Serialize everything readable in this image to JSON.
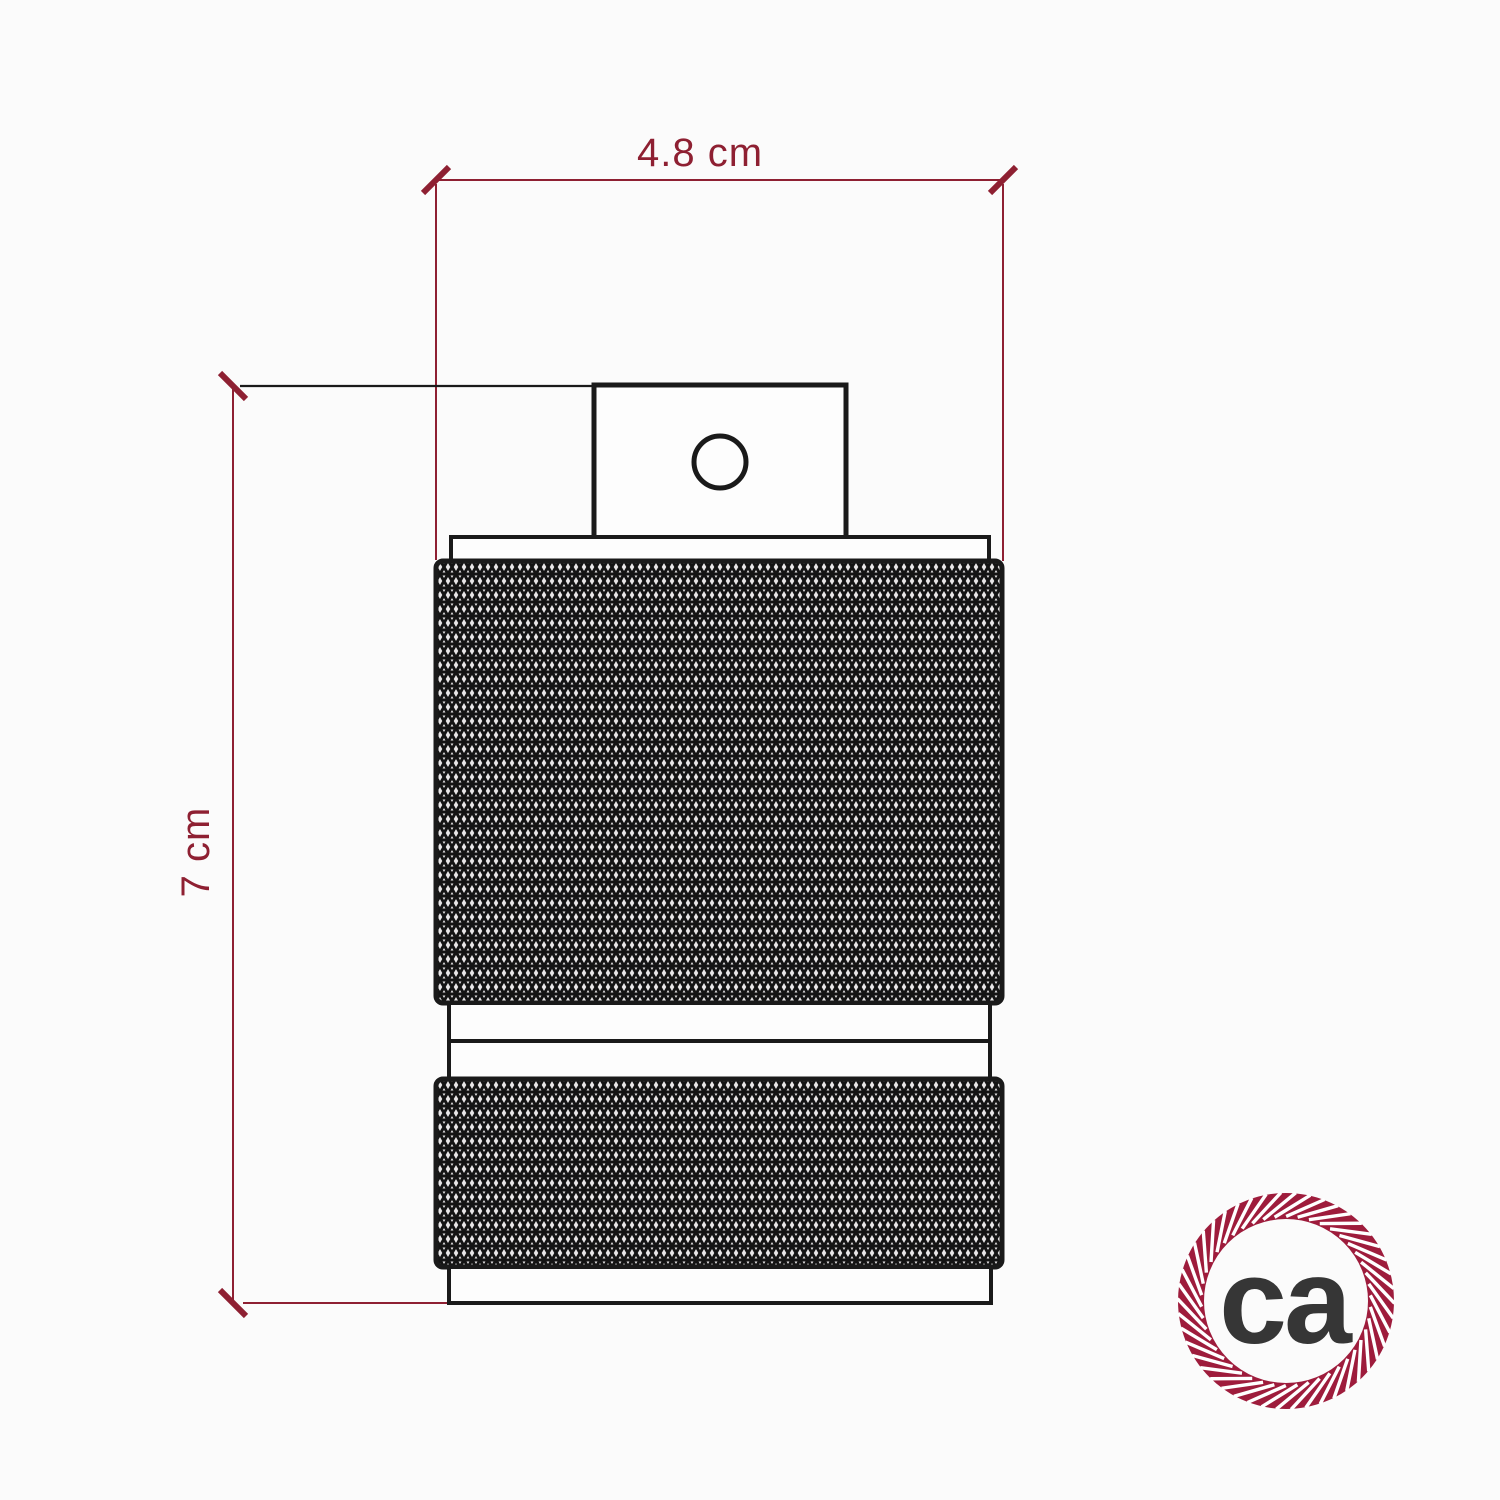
{
  "page": {
    "background": "#fbfbfb"
  },
  "diagram": {
    "width_dimension": {
      "label": "4.8 cm"
    },
    "height_dimension": {
      "label": "7 cm"
    },
    "colors": {
      "dimension": "#8e2032",
      "drawing": "#1a1a1a",
      "knurl_fill": "#e8e6e7",
      "drawing_fill": "#fdfdfd"
    }
  },
  "logo": {
    "text": "ca",
    "ring_color": "#9e1c3c",
    "text_color": "#363636",
    "stripe_color": "#ffffff"
  }
}
